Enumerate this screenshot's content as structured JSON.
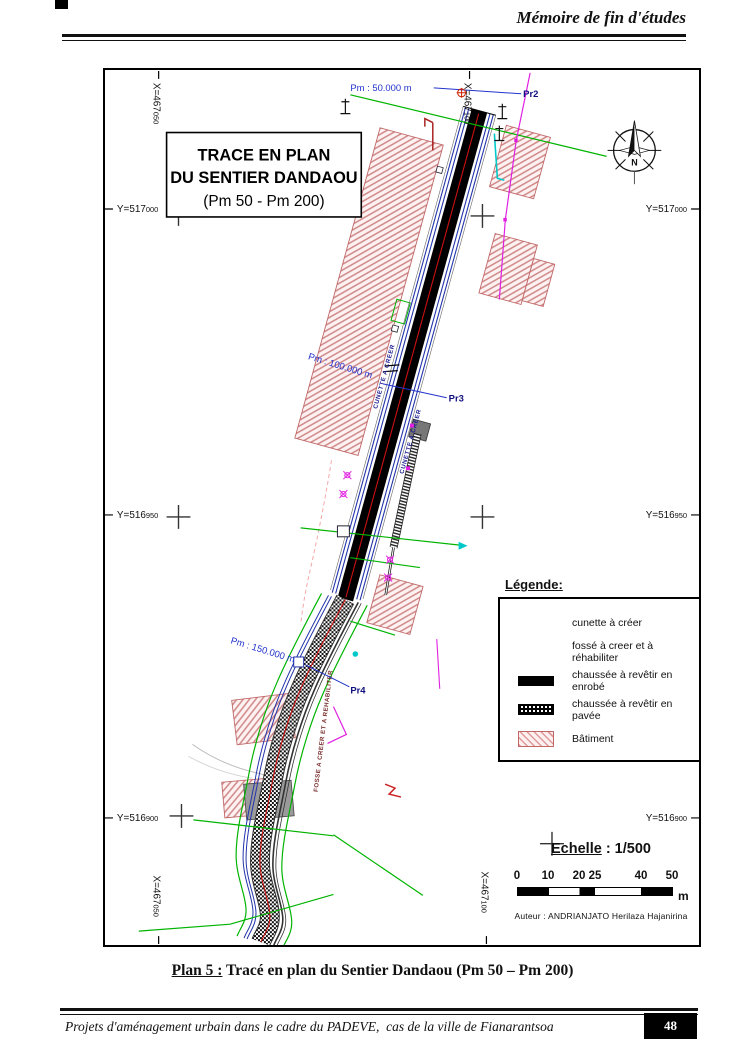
{
  "page": {
    "header_title": "Mémoire de fin d'études",
    "caption_label": "Plan 5 :",
    "caption_text": " Tracé en plan du Sentier Dandaou (Pm 50 – Pm 200)",
    "footer_text": "Projets d'aménagement urbain dans le cadre du PADEVE,  cas de la ville de Fianarantsoa",
    "page_number": "48"
  },
  "plan": {
    "title_line1": "TRACE EN PLAN",
    "title_line2": "DU SENTIER DANDAOU",
    "title_line3": "(Pm 50 - Pm 200)",
    "compass_n": "N",
    "axis": {
      "x_left": {
        "main": "X=467",
        "sub": "050"
      },
      "x_right": {
        "main": "X=467",
        "sub": "100"
      },
      "y1": {
        "main": "Y=517",
        "sub": "000"
      },
      "y2": {
        "main": "Y=516",
        "sub": "950"
      },
      "y3": {
        "main": "Y=516",
        "sub": "900"
      }
    },
    "pm50": "Pm : 50.000 m",
    "pm100": "Pm : 100.000 m",
    "pm150": "Pm : 150.000 m",
    "pr2": "Pr2",
    "pr3": "Pr3",
    "pr4": "Pr4",
    "road_label_cunette": "CUNETTE A CREER",
    "road_label_fosse": "FOSSE A CREER ET A REHABILITER"
  },
  "legend": {
    "title": "Légende:",
    "items": [
      {
        "label": "cunette à créer",
        "type": "blue-lines"
      },
      {
        "label": "fossé à creer et à réhabiliter",
        "type": "green-lines"
      },
      {
        "label": "chaussée à revêtir en enrobé",
        "type": "black-bar"
      },
      {
        "label": "chaussée à revêtir en pavée",
        "type": "paved-bar"
      },
      {
        "label": "Bâtiment",
        "type": "hatched-box"
      }
    ]
  },
  "scale": {
    "label": "Echelle",
    "ratio": ": 1/500",
    "ticks": [
      "0",
      "10",
      "20",
      "25",
      "40",
      "50"
    ],
    "unit": "m",
    "author": "Auteur : ANDRIANJATO Herilaza Hajanirina"
  },
  "colors": {
    "cunette_blue": "#2233aa",
    "fosse_green": "#00b400",
    "centerline_red": "#cc1111",
    "building_hatch": "#d08888",
    "pm_blue": "#2233cc",
    "magenta": "#e020e0",
    "cyan": "#00c8c8",
    "road_black": "#000000"
  }
}
